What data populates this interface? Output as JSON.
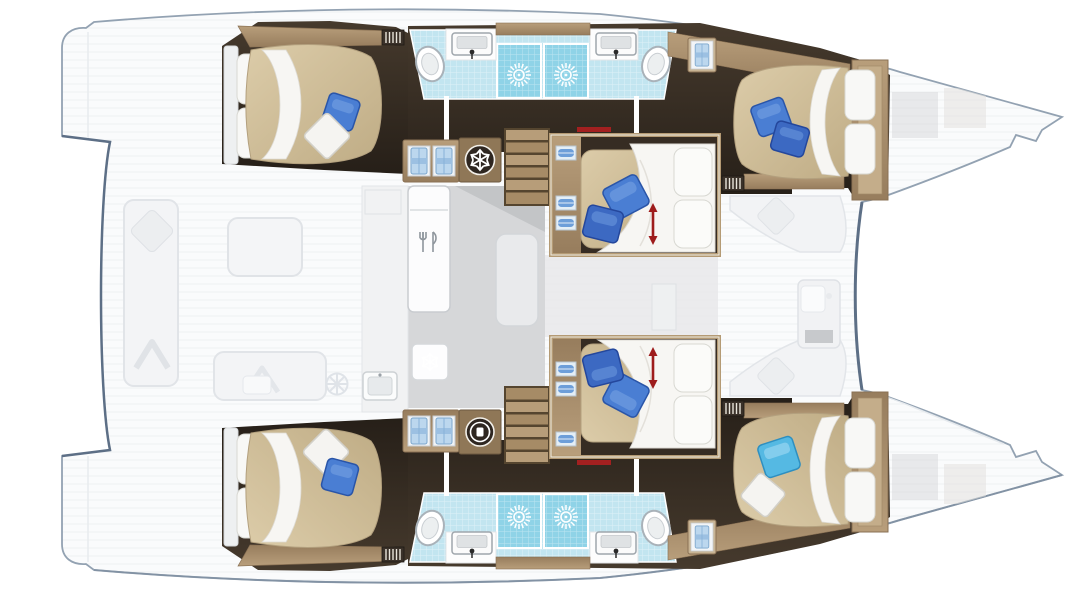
{
  "image": {
    "type": "yacht-floor-plan",
    "subject": "Catamaran interior layout plan, top-down view, bows pointing right",
    "vessel_style": "sailing catamaran, 6-cabin layout",
    "width_px": 1090,
    "height_px": 592
  },
  "hulls": {
    "port_hull_top": {
      "aft_cabin": {
        "name": "aft double cabin",
        "bed": "island double bed",
        "pillows": [
          "white",
          "white",
          "blue",
          "white-diamond"
        ]
      },
      "bathroom": {
        "showers": 2,
        "toilets": 2,
        "sinks": 2,
        "floor": "light blue tile"
      },
      "mid_cabin": {
        "name": "middle double cabin",
        "bed": "convertible double bed",
        "pillows": [
          "blue",
          "blue",
          "white",
          "white"
        ],
        "marker": "red double arrow"
      },
      "forward_cabin": {
        "name": "forward double cabin",
        "bed": "island double bed",
        "pillows": [
          "blue",
          "blue",
          "white",
          "white"
        ]
      },
      "storage": {
        "wardrobe_shirts": 2,
        "fridge_snowflake": true,
        "hanging_locker_shirt": 1
      },
      "stairs": "companionway down to hull"
    },
    "starboard_hull_bottom": {
      "aft_cabin": {
        "name": "aft double cabin",
        "bed": "island double bed",
        "pillows": [
          "white",
          "white",
          "white-diamond",
          "blue"
        ]
      },
      "bathroom": {
        "showers": 2,
        "toilets": 2,
        "sinks": 2,
        "floor": "light blue tile"
      },
      "mid_cabin": {
        "name": "middle double cabin",
        "bed": "convertible double bed",
        "pillows": [
          "blue",
          "blue",
          "white",
          "white"
        ],
        "marker": "red double arrow"
      },
      "forward_cabin": {
        "name": "forward double cabin",
        "bed": "island double bed",
        "pillows": [
          "light-blue",
          "white"
        ]
      },
      "storage": {
        "wardrobe_shirts": 2,
        "washing_machine": true,
        "hanging_locker_shirt": 1
      },
      "stairs": "companionway down to hull"
    }
  },
  "galley": {
    "refrigerator_with_cutlery_icon": true,
    "freezer_snowflake_box": true,
    "sink": true,
    "island_unit": true,
    "floor": "gray"
  },
  "deck_ghosted": {
    "aft_cockpit": [
      "bench seat with diamond cushion",
      "cockpit table",
      "bench with cushion",
      "helm wheel"
    ],
    "saloon": [
      "sofa with diamond cushion",
      "nav desk"
    ],
    "foredeck": [
      "forward beam",
      "trampoline lines",
      "deck hatches"
    ]
  },
  "icons": [
    {
      "name": "shower-sun-icon",
      "meaning": "shower",
      "count": 4
    },
    {
      "name": "toilet-icon",
      "count": 4
    },
    {
      "name": "sink-icon",
      "count": 4
    },
    {
      "name": "snowflake-icon",
      "meaning": "fridge / freezer",
      "count": 2
    },
    {
      "name": "washing-machine-icon",
      "count": 1
    },
    {
      "name": "wardrobe-shirts-icon",
      "count": 2
    },
    {
      "name": "hanging-locker-shirt-icon",
      "count": 2
    },
    {
      "name": "cutlery-icon",
      "meaning": "galley refrigerator",
      "count": 1
    },
    {
      "name": "convertible-bed-arrow-icon",
      "count": 2
    },
    {
      "name": "helm-wheel-icon",
      "count": 1
    }
  ],
  "palette": {
    "background": "#ffffff",
    "hull_outline": "#93a2b2",
    "hull_accent": "#5d6f86",
    "ghost_fill": "#f3f4f6",
    "ghost_stroke": "#e1e4e8",
    "dark_wood": "#2c241d",
    "tan_wood": "#a98f6c",
    "mattress": "#cdbc9a",
    "tile": "#c2e5f0",
    "shower_tile": "#8fd3e7",
    "pillow_blue": "#4a7ed3",
    "pillow_light_blue": "#55b9e3",
    "red_marker": "#9e1c1c",
    "galley_floor": "#d6d7d9"
  }
}
